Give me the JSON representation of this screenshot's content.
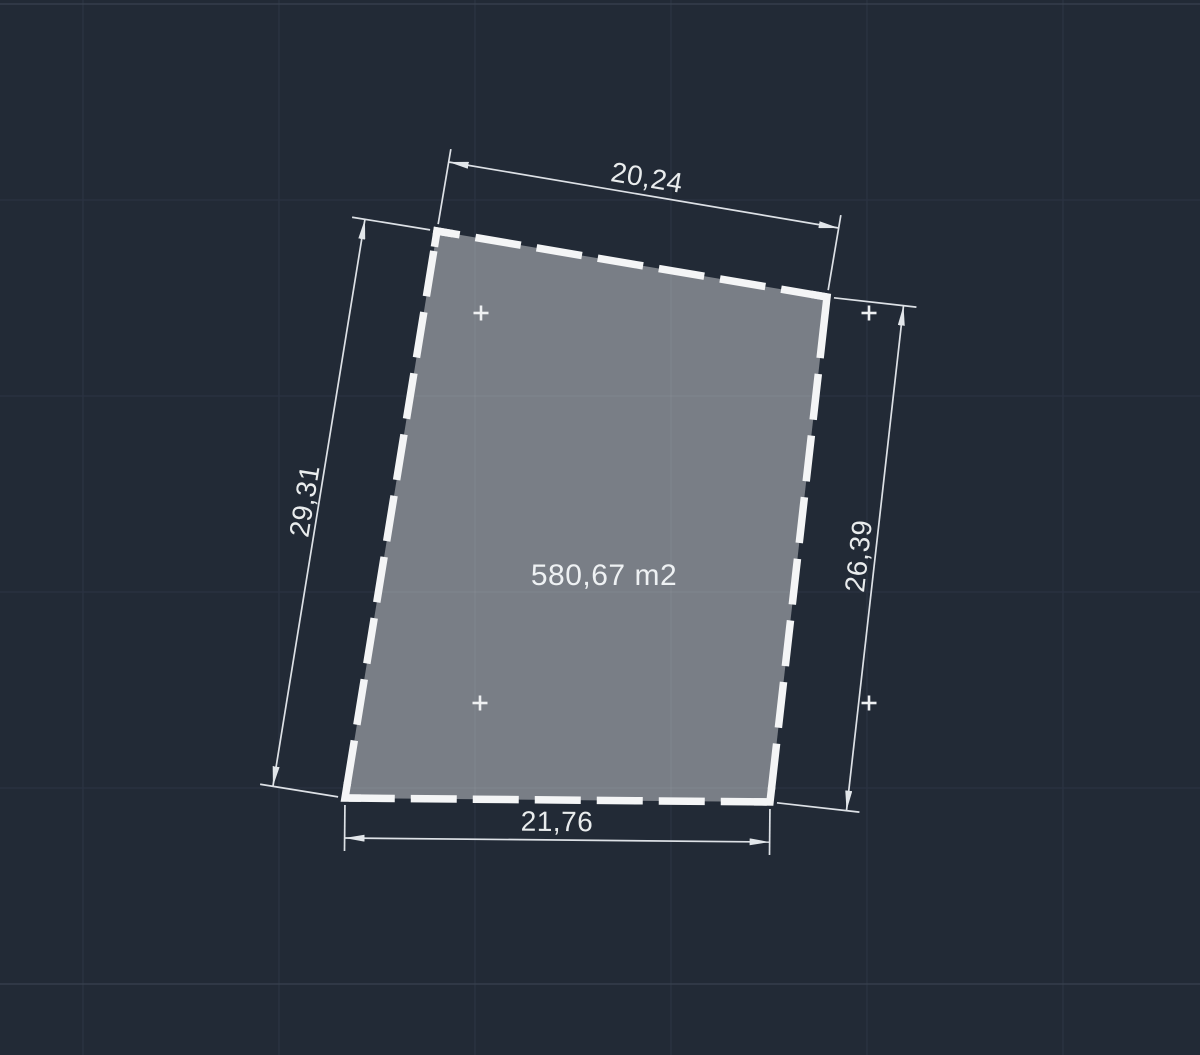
{
  "canvas": {
    "width": 1200,
    "height": 1055,
    "background": "#222a36",
    "grid": {
      "spacing": 196,
      "vertical_x": [
        83,
        279,
        475,
        671,
        867,
        1063
      ],
      "horizontal_y": [
        4,
        200,
        396,
        592,
        788,
        984
      ],
      "major_horizontal_y": [
        4,
        984
      ],
      "minor_color": "#2b3342",
      "major_color": "#39424f"
    }
  },
  "parcel": {
    "area_label": "580,67 m2",
    "area_label_pos": [
      604,
      576
    ],
    "corners": [
      [
        437,
        231
      ],
      [
        827,
        297
      ],
      [
        770,
        802
      ],
      [
        345,
        798
      ]
    ],
    "fill_color": "#797e86",
    "outline_color": "#f4f5f6",
    "outline_width": 7.5,
    "dash_pattern": [
      46,
      16
    ],
    "grid_showthrough_color": "rgba(255,255,255,0.05)"
  },
  "dimensions": [
    {
      "id": "top",
      "label": "20,24",
      "p1": [
        437,
        231
      ],
      "p2": [
        827,
        297
      ],
      "offset": 70,
      "text_offset": 17
    },
    {
      "id": "left",
      "label": "29,31",
      "p1": [
        437,
        231
      ],
      "p2": [
        345,
        798
      ],
      "offset": -73,
      "text_offset": -14
    },
    {
      "id": "right",
      "label": "26,39",
      "p1": [
        827,
        297
      ],
      "p2": [
        770,
        802
      ],
      "offset": 77,
      "text_offset": -16
    },
    {
      "id": "bottom",
      "label": "21,76",
      "p1": [
        345,
        798
      ],
      "p2": [
        770,
        802
      ],
      "offset": -40,
      "text_offset": 18
    }
  ],
  "dimension_style": {
    "line_color": "#dde1e6",
    "line_width": 1.7,
    "arrow_color": "#e2e6ea",
    "ext_gap": 7,
    "ext_overshoot": 13
  },
  "markers": {
    "positions": [
      [
        481,
        313
      ],
      [
        869,
        313
      ],
      [
        480,
        703
      ],
      [
        869,
        703
      ]
    ],
    "size": 15,
    "stroke_width": 2.6,
    "color": "#eef0f2"
  }
}
